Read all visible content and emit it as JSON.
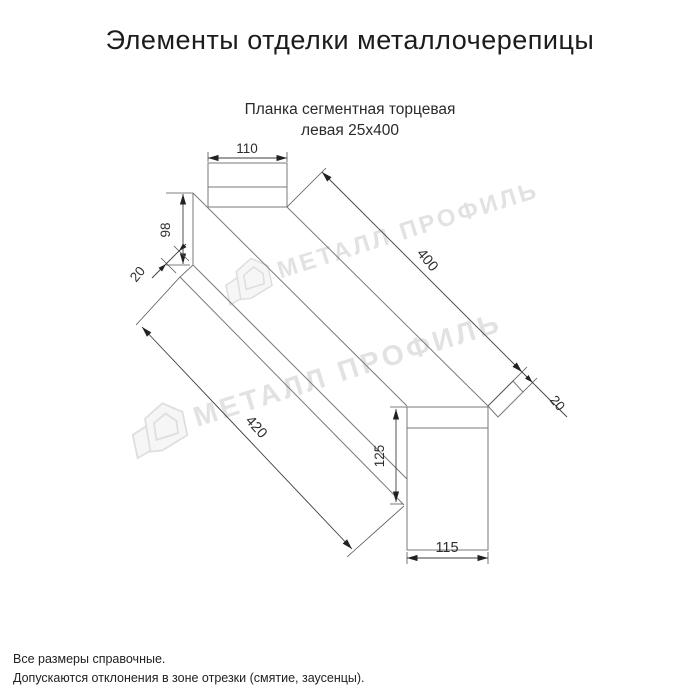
{
  "page": {
    "title": "Элементы отделки металлочерепицы",
    "background": "#ffffff"
  },
  "product": {
    "name_line1": "Планка сегментная торцевая",
    "name_line2": "левая 25х400"
  },
  "dimensions": {
    "top_flange_width": "110",
    "left_face_height": "98",
    "left_hem": "20",
    "length_top": "400",
    "length_bottom": "420",
    "right_hem": "20",
    "end_face_height": "125",
    "end_face_width": "115"
  },
  "watermark": {
    "text": "МЕТАЛЛ ПРОФИЛЬ",
    "color": "#e2e2e2"
  },
  "footer": {
    "line1": "Все размеры справочные.",
    "line2": "Допускаются отклонения в зоне отрезки (смятие, заусенцы)."
  },
  "colors": {
    "geometry_line": "#7a7a7a",
    "dimension_line": "#3d3d3d",
    "text": "#1c1c1c",
    "watermark": "#e2e2e2"
  }
}
